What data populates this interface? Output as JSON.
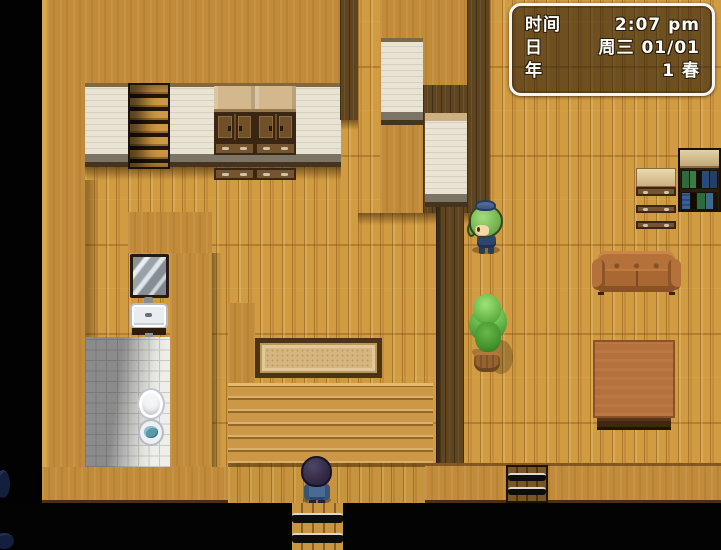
{
  "hud": {
    "rows": [
      {
        "label": "时间",
        "value": "2:07 pm"
      },
      {
        "label": "日",
        "value": "周三 01/01"
      },
      {
        "label": "年",
        "value": "1 春"
      }
    ]
  },
  "palette": {
    "wall_tan": "#c28b39",
    "floor_wood": "#d09b41",
    "divider_walnut": "#5f4420",
    "wall_panel_cream": "#e8e3d3",
    "bathroom_tile": "#eeeeea",
    "porch_plank": "#cc9848",
    "couch_leather": "#b06f3c",
    "table_wood": "#b5713b",
    "plant_green": "#57a83d",
    "hud_border": "#f4f4f4",
    "hud_text": "#ffffff",
    "outside_black": "#020202"
  }
}
